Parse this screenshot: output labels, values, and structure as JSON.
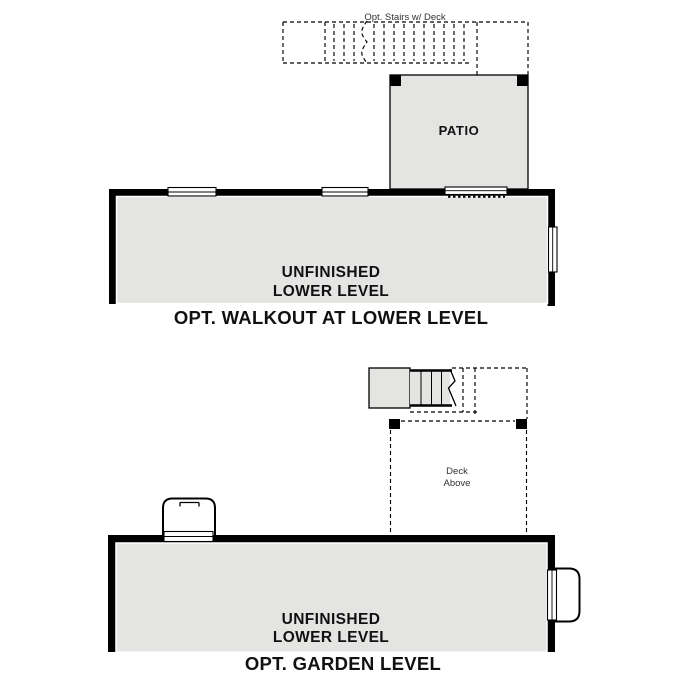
{
  "colors": {
    "floor_fill": "#e4e4e2",
    "wall": "#000000",
    "background": "#ffffff",
    "label_text": "#111111",
    "annotation_text": "#333333"
  },
  "walkout_plan": {
    "stairs_label": "Opt. Stairs w/ Deck",
    "patio_label": "PATIO",
    "room_label_line1": "UNFINISHED",
    "room_label_line2": "LOWER LEVEL",
    "caption": "OPT. WALKOUT AT LOWER LEVEL"
  },
  "garden_plan": {
    "deck_label_line1": "Deck",
    "deck_label_line2": "Above",
    "room_label_line1": "UNFINISHED",
    "room_label_line2": "LOWER LEVEL",
    "caption": "OPT. GARDEN LEVEL"
  }
}
